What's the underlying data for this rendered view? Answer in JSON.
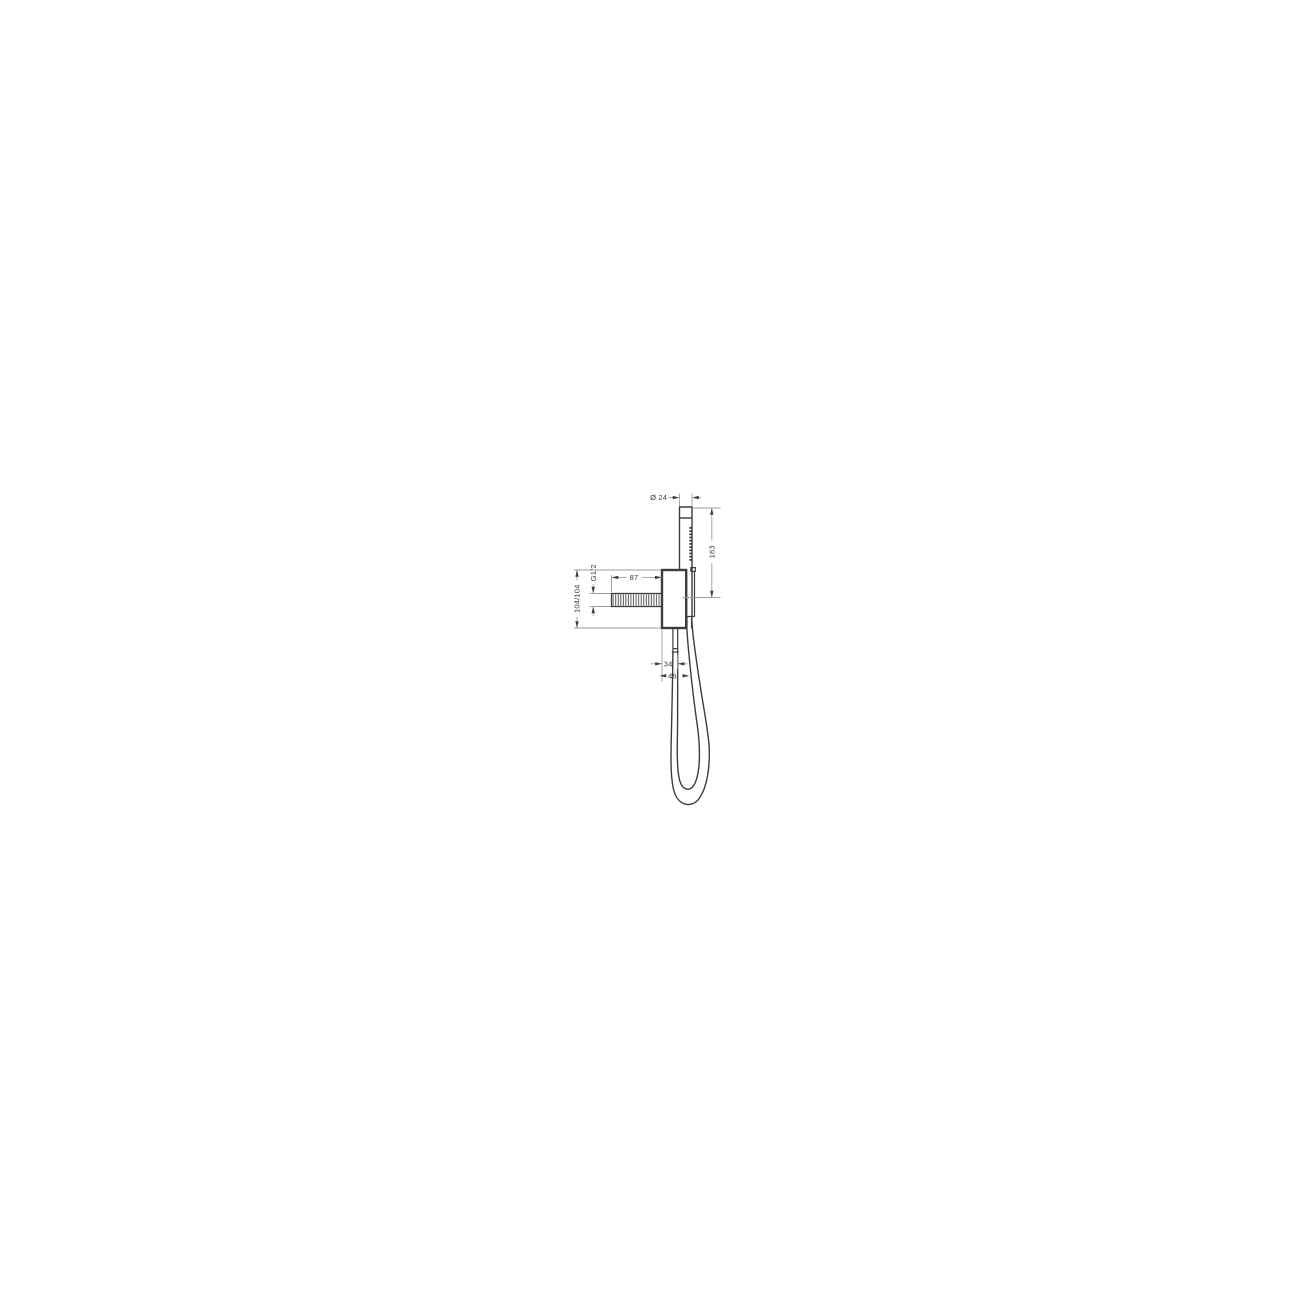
{
  "drawing": {
    "colors": {
      "outline": "#3c3c3b",
      "dimension_line": "#9d9d9c",
      "label_text": "#3c3c3b",
      "background": "#ffffff"
    },
    "labels": {
      "diameter": "Ø 24",
      "length": "163",
      "reach": "87",
      "thread": "G1/2",
      "heights": "104/104",
      "offset_inner": "34",
      "offset_outer": "46"
    }
  }
}
